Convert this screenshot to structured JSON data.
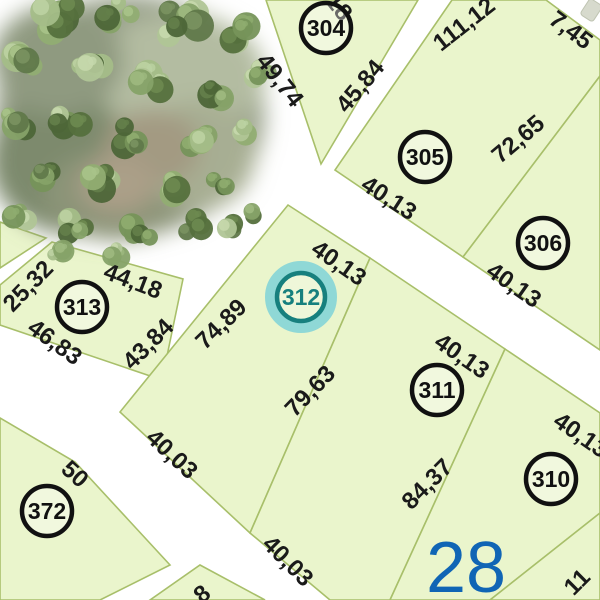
{
  "map": {
    "block_number": "28",
    "selected_parcel_id": "312",
    "colors": {
      "parcel_fill": "#eaf5cc",
      "parcel_stroke": "#a8bf6a",
      "road": "#ffffff",
      "dimension_text": "#1a1a1a",
      "badge_ring": "#111111",
      "highlight_ring": "#17807e",
      "highlight_halo": "#8fd8d6",
      "block_number": "#1065b5"
    },
    "badges": [
      {
        "id": "304",
        "x": 326,
        "y": 28,
        "highlighted": false
      },
      {
        "id": "305",
        "x": 425,
        "y": 157,
        "highlighted": false
      },
      {
        "id": "306",
        "x": 543,
        "y": 243,
        "highlighted": false
      },
      {
        "id": "313",
        "x": 82,
        "y": 307,
        "highlighted": false
      },
      {
        "id": "312",
        "x": 301,
        "y": 297,
        "highlighted": true
      },
      {
        "id": "311",
        "x": 437,
        "y": 390,
        "highlighted": false
      },
      {
        "id": "310",
        "x": 551,
        "y": 479,
        "highlighted": false
      },
      {
        "id": "372",
        "x": 47,
        "y": 511,
        "highlighted": false
      }
    ],
    "dimensions": [
      {
        "text": "49,74",
        "x": 280,
        "y": 80,
        "rot": 52
      },
      {
        "text": "45,84",
        "x": 360,
        "y": 86,
        "rot": -50
      },
      {
        "text": "111,12",
        "x": 464,
        "y": 24,
        "rot": -38
      },
      {
        "text": "7,45",
        "x": 571,
        "y": 30,
        "rot": 37
      },
      {
        "text": "72,65",
        "x": 518,
        "y": 139,
        "rot": -40
      },
      {
        "text": "40,13",
        "x": 389,
        "y": 198,
        "rot": 33
      },
      {
        "text": "40,13",
        "x": 339,
        "y": 263,
        "rot": 35
      },
      {
        "text": "40,13",
        "x": 514,
        "y": 285,
        "rot": 35
      },
      {
        "text": "40,13",
        "x": 462,
        "y": 356,
        "rot": 35
      },
      {
        "text": "40,13",
        "x": 581,
        "y": 435,
        "rot": 35
      },
      {
        "text": "25,32",
        "x": 28,
        "y": 286,
        "rot": -46
      },
      {
        "text": "44,18",
        "x": 133,
        "y": 281,
        "rot": 21
      },
      {
        "text": "46,83",
        "x": 55,
        "y": 342,
        "rot": 36
      },
      {
        "text": "43,84",
        "x": 148,
        "y": 344,
        "rot": -45
      },
      {
        "text": "74,89",
        "x": 221,
        "y": 324,
        "rot": -44
      },
      {
        "text": "79,63",
        "x": 310,
        "y": 391,
        "rot": -46
      },
      {
        "text": "84,37",
        "x": 427,
        "y": 484,
        "rot": -45
      },
      {
        "text": "40,03",
        "x": 172,
        "y": 454,
        "rot": 43
      },
      {
        "text": "40,03",
        "x": 288,
        "y": 561,
        "rot": 45
      },
      {
        "text": "50",
        "x": 75,
        "y": 474,
        "rot": 42
      },
      {
        "text": "18",
        "x": 339,
        "y": 7,
        "rot": 52
      },
      {
        "text": "11",
        "x": 577,
        "y": 582,
        "rot": -45
      },
      {
        "text": "8",
        "x": 202,
        "y": 594,
        "rot": -40
      }
    ],
    "block_label": {
      "text": "28",
      "x": 466,
      "y": 592
    }
  }
}
